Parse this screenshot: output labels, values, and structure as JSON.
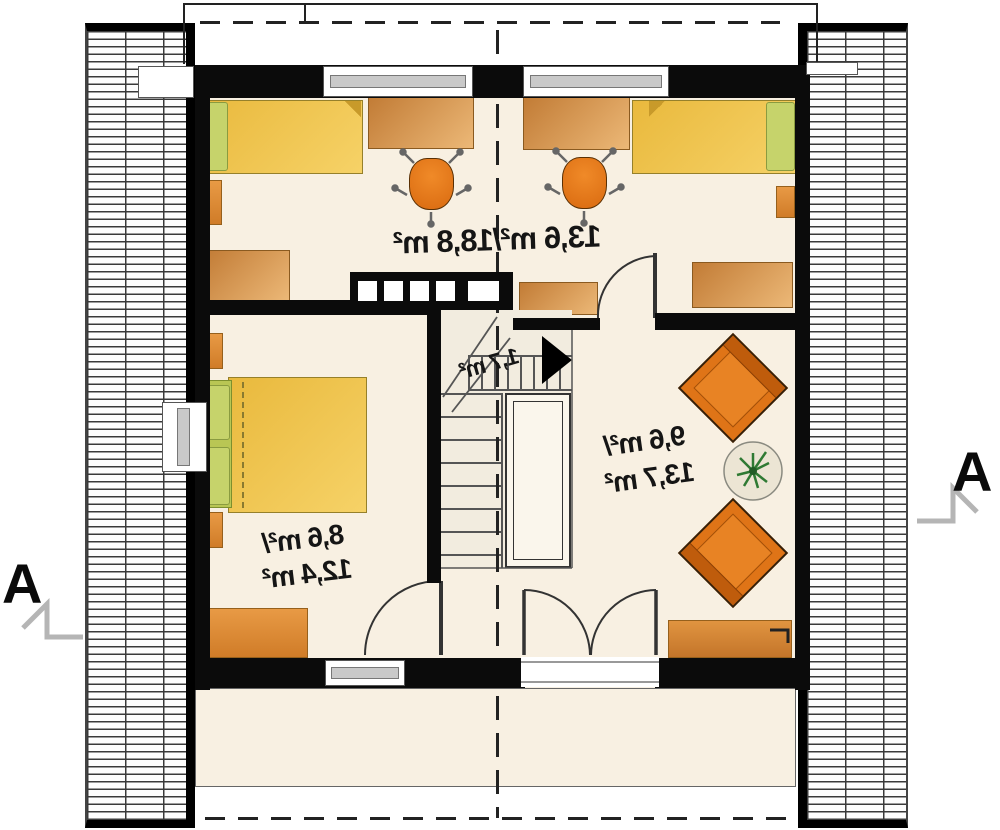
{
  "plan": {
    "type": "attic floor plan, mirrored layout",
    "labels": {
      "top_room_area": "13,6 m²/18,8 m²",
      "stairs_area": "1,7 m²",
      "hall_area_line1": "9,6 m²/",
      "hall_area_line2": "13,7 m²",
      "bedroom_area_line1": "8,6 m²/",
      "bedroom_area_line2": "12,4 m²",
      "section_marker_left": "A",
      "section_marker_right": "A"
    },
    "rooms": [
      {
        "name": "kids-room",
        "area_over_1_9m": "13,6 m²",
        "area_total": "18,8 m²"
      },
      {
        "name": "staircase",
        "area": "1,7 m²"
      },
      {
        "name": "hall-sitting-area",
        "area_over_1_9m": "9,6 m²",
        "area_total": "13,7 m²"
      },
      {
        "name": "bedroom",
        "area_over_1_9m": "8,6 m²",
        "area_total": "12,4 m²"
      }
    ],
    "furniture": {
      "kids_room": [
        "single-bed-left",
        "single-bed-right",
        "desk-left",
        "desk-right",
        "office-chair-left",
        "office-chair-right",
        "wardrobe",
        "cabinet-left",
        "cabinet-right",
        "nightstand-left",
        "nightstand-right"
      ],
      "bedroom": [
        "double-bed",
        "headboard-with-pillows",
        "nightstand-top",
        "nightstand-bottom",
        "dresser"
      ],
      "hall": [
        "armchair-top",
        "armchair-bottom",
        "round-table-with-plant",
        "sideboard"
      ],
      "stairs": [
        "winder-staircase",
        "chimney-with-5-flues",
        "direction-arrow"
      ]
    },
    "features": [
      "roof-slope-hatch-left",
      "roof-slope-hatch-right",
      "ridge-center-dashed-line",
      "eaves-dashed-line-top",
      "eaves-dashed-line-bottom",
      "double-french-door",
      "section-line-A-A"
    ],
    "colors": {
      "wall": "#0b0b0b",
      "floor": "#f8f0e2",
      "bed_yellow": "#f0c24a",
      "pillow_green": "#c6d36b",
      "furniture_orange": "#df7417",
      "wood_brown": "#c27c36",
      "window_gray": "#c9c9c9",
      "dash_line": "#222222",
      "section_arrow": "#b5b5b5",
      "plant_green": "#2f7a33",
      "text": "#151515"
    }
  }
}
